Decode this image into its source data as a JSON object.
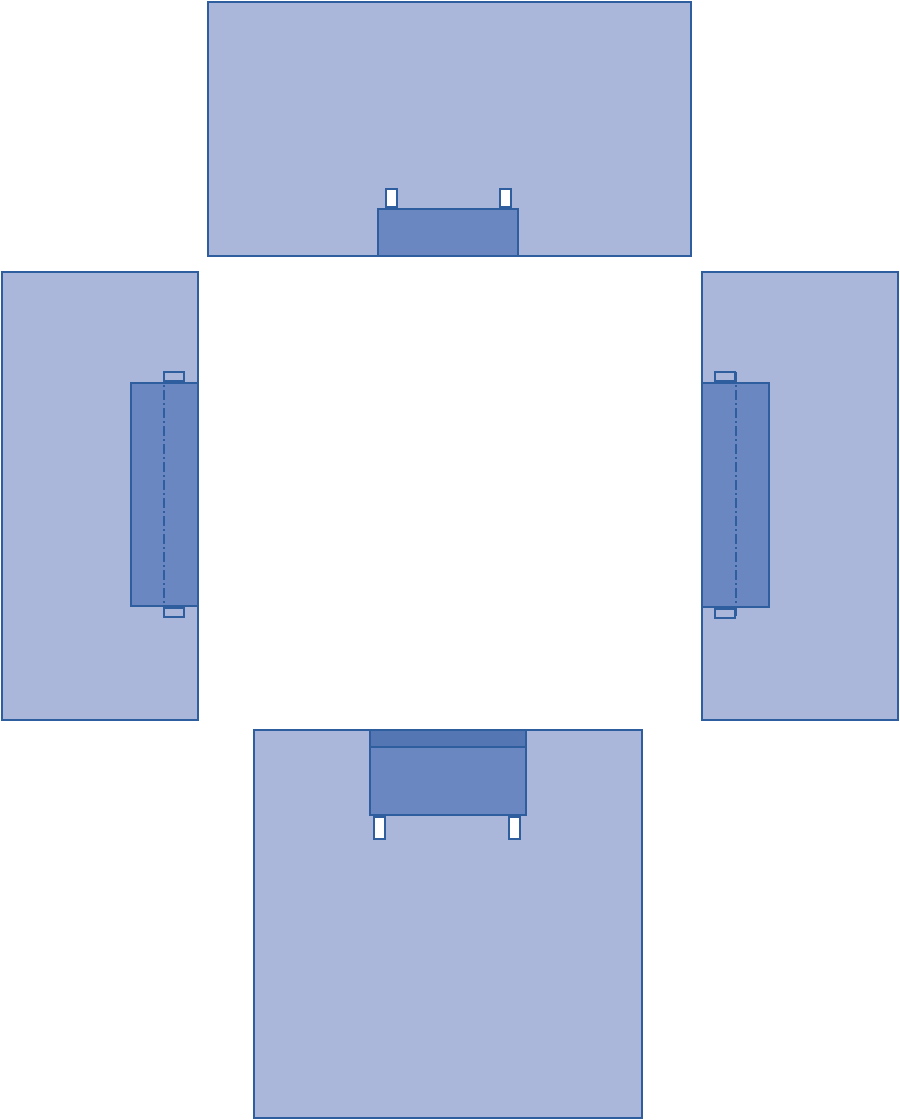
{
  "diagram": {
    "type": "four-panel-drape-layout",
    "description": "Four light blue drape panels arranged around an empty center (top, left, right, bottom views), each with a dark blue reinforcement rectangle and small attachment tabs",
    "canvas": {
      "width": 900,
      "height": 1120,
      "background": "#FFFFFF"
    },
    "colors": {
      "panel_fill": "#AAB7DB",
      "overlay_fill": "#6A87C1",
      "band_fill": "#5477B4",
      "tab_white_fill": "#FFFFFF",
      "border": "#2E5E9E",
      "centerline": "#2E5E9E"
    },
    "panels": [
      {
        "id": "top",
        "x": 207,
        "y": 1,
        "w": 485,
        "h": 256,
        "overlay": {
          "x": 377,
          "y": 208,
          "w": 142,
          "h": 49
        },
        "tabs": [
          {
            "x": 385,
            "y": 188,
            "w": 13,
            "h": 20,
            "fill": "white"
          },
          {
            "x": 499,
            "y": 188,
            "w": 13,
            "h": 20,
            "fill": "white"
          }
        ]
      },
      {
        "id": "left",
        "x": 1,
        "y": 271,
        "w": 198,
        "h": 450,
        "overlay": {
          "x": 130,
          "y": 382,
          "w": 69,
          "h": 225
        },
        "tabs": [
          {
            "x": 163,
            "y": 371,
            "w": 22,
            "h": 11,
            "fill": "transparent"
          },
          {
            "x": 163,
            "y": 607,
            "w": 22,
            "h": 11,
            "fill": "transparent"
          }
        ],
        "centerline": {
          "x": 163,
          "y1": 372,
          "y2": 617
        }
      },
      {
        "id": "right",
        "x": 701,
        "y": 271,
        "w": 198,
        "h": 450,
        "overlay": {
          "x": 701,
          "y": 382,
          "w": 69,
          "h": 226
        },
        "tabs": [
          {
            "x": 714,
            "y": 371,
            "w": 22,
            "h": 11,
            "fill": "transparent"
          },
          {
            "x": 714,
            "y": 608,
            "w": 22,
            "h": 11,
            "fill": "transparent"
          }
        ],
        "centerline": {
          "x": 735,
          "y1": 372,
          "y2": 618
        }
      },
      {
        "id": "bottom",
        "x": 253,
        "y": 729,
        "w": 390,
        "h": 390,
        "overlay": {
          "x": 369,
          "y": 729,
          "w": 158,
          "h": 87,
          "band_h": 15
        },
        "tabs": [
          {
            "x": 373,
            "y": 816,
            "w": 13,
            "h": 24,
            "fill": "white"
          },
          {
            "x": 508,
            "y": 816,
            "w": 13,
            "h": 24,
            "fill": "white"
          }
        ]
      }
    ]
  }
}
